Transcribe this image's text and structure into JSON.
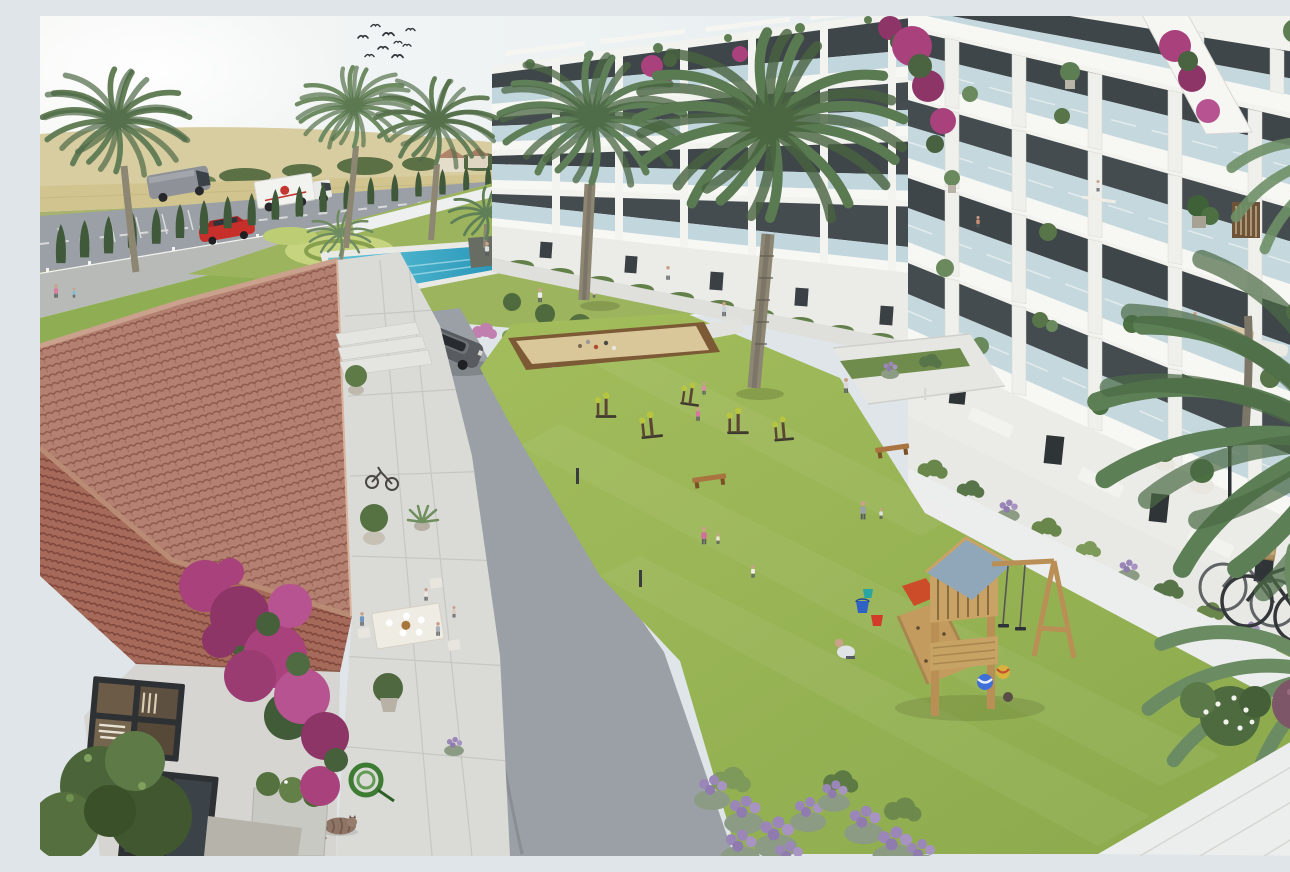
{
  "image": {
    "title": "Aerial 3D architectural rendering of a residential apartment complex with communal gardens, pool and playground",
    "width_px": 1290,
    "height_px": 840
  },
  "colors": {
    "sky_left": "#f6f7f5",
    "sky_right": "#dfe9ee",
    "field_wheat": "#d2c48e",
    "field_wheat_light": "#dcd09c",
    "field_green": "#a9b26e",
    "field_green_dark": "#99a660",
    "hill_far": "#d8cda1",
    "tree_line": "#5c7046",
    "road_asphalt": "#9aa0a5",
    "sidewalk_grey": "#b7bab6",
    "path_concrete": "#e2e3df",
    "pavement_light": "#eceded",
    "lawn_green": "#9ab453",
    "lawn_highlight": "#c6d37f",
    "garden_green": "#9cb45e",
    "gravel_tan": "#c4a88b",
    "pool_water_light": "#63c6d8",
    "pool_water_deep": "#2391b6",
    "pool_deck": "#e9eae6",
    "cypress_green": "#41593b",
    "palm_frond": "#6e8b62",
    "palm_trunk": "#8d8673",
    "building_white": "#f2f2ee",
    "balcony_slab": "#f7f7f4",
    "balcony_glass": "#bdd3db",
    "window_glass_dark": "#3f464a",
    "ground_floor_wall": "#ebebe7",
    "roof_tile": "#b48071",
    "roof_tile_shadow": "#8f5a4b",
    "roof_ridge": "#c9a08b",
    "house_wall": "#d6d5d1",
    "terrace_tile": "#dadbd7",
    "bougainvillea_pink": "#a8417c",
    "bougainvillea_deep": "#8e3567",
    "lavender_purple": "#9a87b8",
    "shrub_green": "#69864b",
    "bocce_sand": "#d9c699",
    "bocce_wood": "#7c5a36",
    "play_wood": "#c9a266",
    "play_roof_blue": "#8fa7b8",
    "slide_red": "#cc4b28",
    "bucket_blue": "#2f62c4",
    "bucket_red": "#d23b2a",
    "bucket_teal": "#2aa6a0",
    "ball_blue": "#3f6fd8",
    "ball_yellow": "#d8b13f",
    "car_red": "#c62f2a",
    "van_grey": "#8e9298",
    "truck_white": "#f2f2ef",
    "suv_grey": "#585c61",
    "bike_frame": "#34373a",
    "cat_fur": "#8d7465",
    "hose_green": "#3e7c33",
    "skin": "#caa189"
  },
  "scene": {
    "sky": {
      "birds": 9,
      "weather": "hazy sunshine"
    },
    "background": {
      "fields": "wheat and green crop fields",
      "village_houses": 3,
      "perimeter": "cypress hedge along access road"
    },
    "vehicles": [
      {
        "type": "panel van",
        "location": "access road"
      },
      {
        "type": "delivery box truck",
        "location": "access road"
      },
      {
        "type": "red car",
        "location": "parking bays"
      },
      {
        "type": "grey SUV",
        "location": "internal driveway"
      }
    ],
    "pool_area": {
      "type": "communal lap pool",
      "swimmers": 3,
      "features": [
        "island planter with palm",
        "white sun loungers",
        "ornamental topiary lawn"
      ]
    },
    "buildings": [
      {
        "name": "north block",
        "floors_visible": 4,
        "style": "white render, continuous balconies, glass balustrades, rooftop pergolas"
      },
      {
        "name": "east block",
        "floors_visible": 5,
        "style": "white render, staggered balconies, glass balustrades, potted plants, bougainvillea"
      }
    ],
    "mediterranean_house": {
      "roof": "terracotta barrel tiles",
      "walls": "whitewashed",
      "terrace_items": [
        "dining table with four people",
        "potted olive trees",
        "agave pot",
        "ornamental bicycle",
        "coiled garden hose",
        "sleeping cat",
        "planter with shrubs"
      ],
      "climbing_plant": "magenta bougainvillea"
    },
    "courtyard": {
      "lawn": "large communal lawn",
      "petanque_court": {
        "surface": "sand",
        "edging": "timber"
      },
      "outdoor_gym_stations": 5,
      "benches": 2,
      "playground": {
        "tower": "timber with blue-grey gable roof",
        "equipment": [
          "climbing wall",
          "double swing",
          "red slide"
        ],
        "toys": [
          "blue bucket",
          "red bucket",
          "teal bucket",
          "three balls"
        ]
      },
      "planting": [
        "lavender beds",
        "clipped green shrubs",
        "white flowering shrub"
      ]
    },
    "people": {
      "terrace_diners": 4,
      "in_or_at_pool": 4,
      "on_lawn": 10,
      "on_paths": 5,
      "on_balconies": 3
    },
    "bicycles_parked": 2,
    "palm_trees_large": 6
  }
}
